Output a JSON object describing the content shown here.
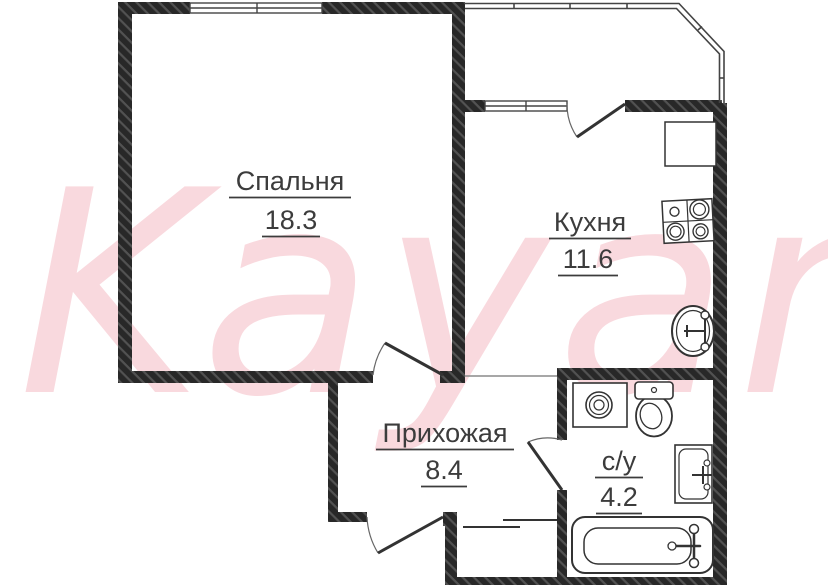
{
  "watermark": {
    "text": "Kayan",
    "color": "#f9d9de"
  },
  "rooms": [
    {
      "name": "bedroom",
      "label": "Спальня",
      "area": "18.3"
    },
    {
      "name": "kitchen",
      "label": "Кухня",
      "area": "11.6"
    },
    {
      "name": "hallway",
      "label": "Прихожая",
      "area": "8.4"
    },
    {
      "name": "bathroom",
      "label": "с/у",
      "area": "4.2"
    }
  ],
  "fixtures": [
    "stove",
    "kitchen-counter",
    "kitchen-sink",
    "washing-machine",
    "toilet",
    "bathroom-sink",
    "bathtub"
  ],
  "colors": {
    "wall": "#282828",
    "wall_hatch": "#525252",
    "line": "#3a3a3a",
    "text": "#3c3c3c",
    "background": "#ffffff"
  }
}
